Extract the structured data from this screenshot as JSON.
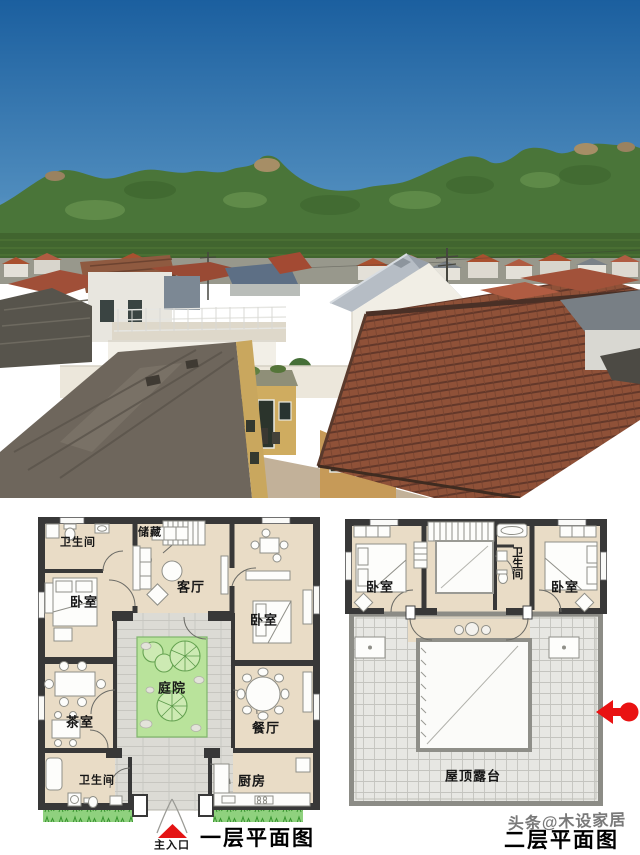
{
  "photo": {
    "colors": {
      "sky_top": "#1b5f9f",
      "sky_horizon": "#85b2d3",
      "mountain_green": "#4a7539",
      "mountain_shadow": "#35592b",
      "rock_tan": "#a68e66",
      "clay_tile_roof": "#8f5138",
      "metal_roof_gray": "#a9b1b9",
      "new_house_white": "#f1eee5",
      "old_wall_yellow": "#c9a75e",
      "old_flat_roof": "#6e665c",
      "ground_tan": "#c2b199"
    }
  },
  "plans": {
    "wall_color": "#383838",
    "room_fill": "#e9dcc6",
    "paving_fill": "#dcdbd5",
    "garden_fill": "#b9e39b",
    "terrace_fill": "#e7e7e3",
    "grass_fill": "#8fd17e",
    "accent_red": "#e81414",
    "plan1": {
      "title": "一层平面图",
      "entrance_label": "主入口",
      "rooms": {
        "bathroom_top": "卫生间",
        "storage": "储藏",
        "living_room": "客厅",
        "bedroom_left": "卧室",
        "bedroom_right": "卧室",
        "courtyard": "庭院",
        "tea_room": "茶室",
        "dining_room": "餐厅",
        "bathroom_bottom": "卫生间",
        "kitchen": "厨房"
      }
    },
    "plan2": {
      "title": "二层平面图",
      "rooms": {
        "bedroom_left": "卧室",
        "bathroom": "卫生间",
        "bedroom_right": "卧室",
        "roof_terrace": "屋顶露台"
      }
    }
  },
  "watermark": {
    "text": "头条@木设家居"
  },
  "icons": {
    "main_entrance_arrow": "red-triangle-up",
    "direction_arrow": "red-arrow-left"
  }
}
